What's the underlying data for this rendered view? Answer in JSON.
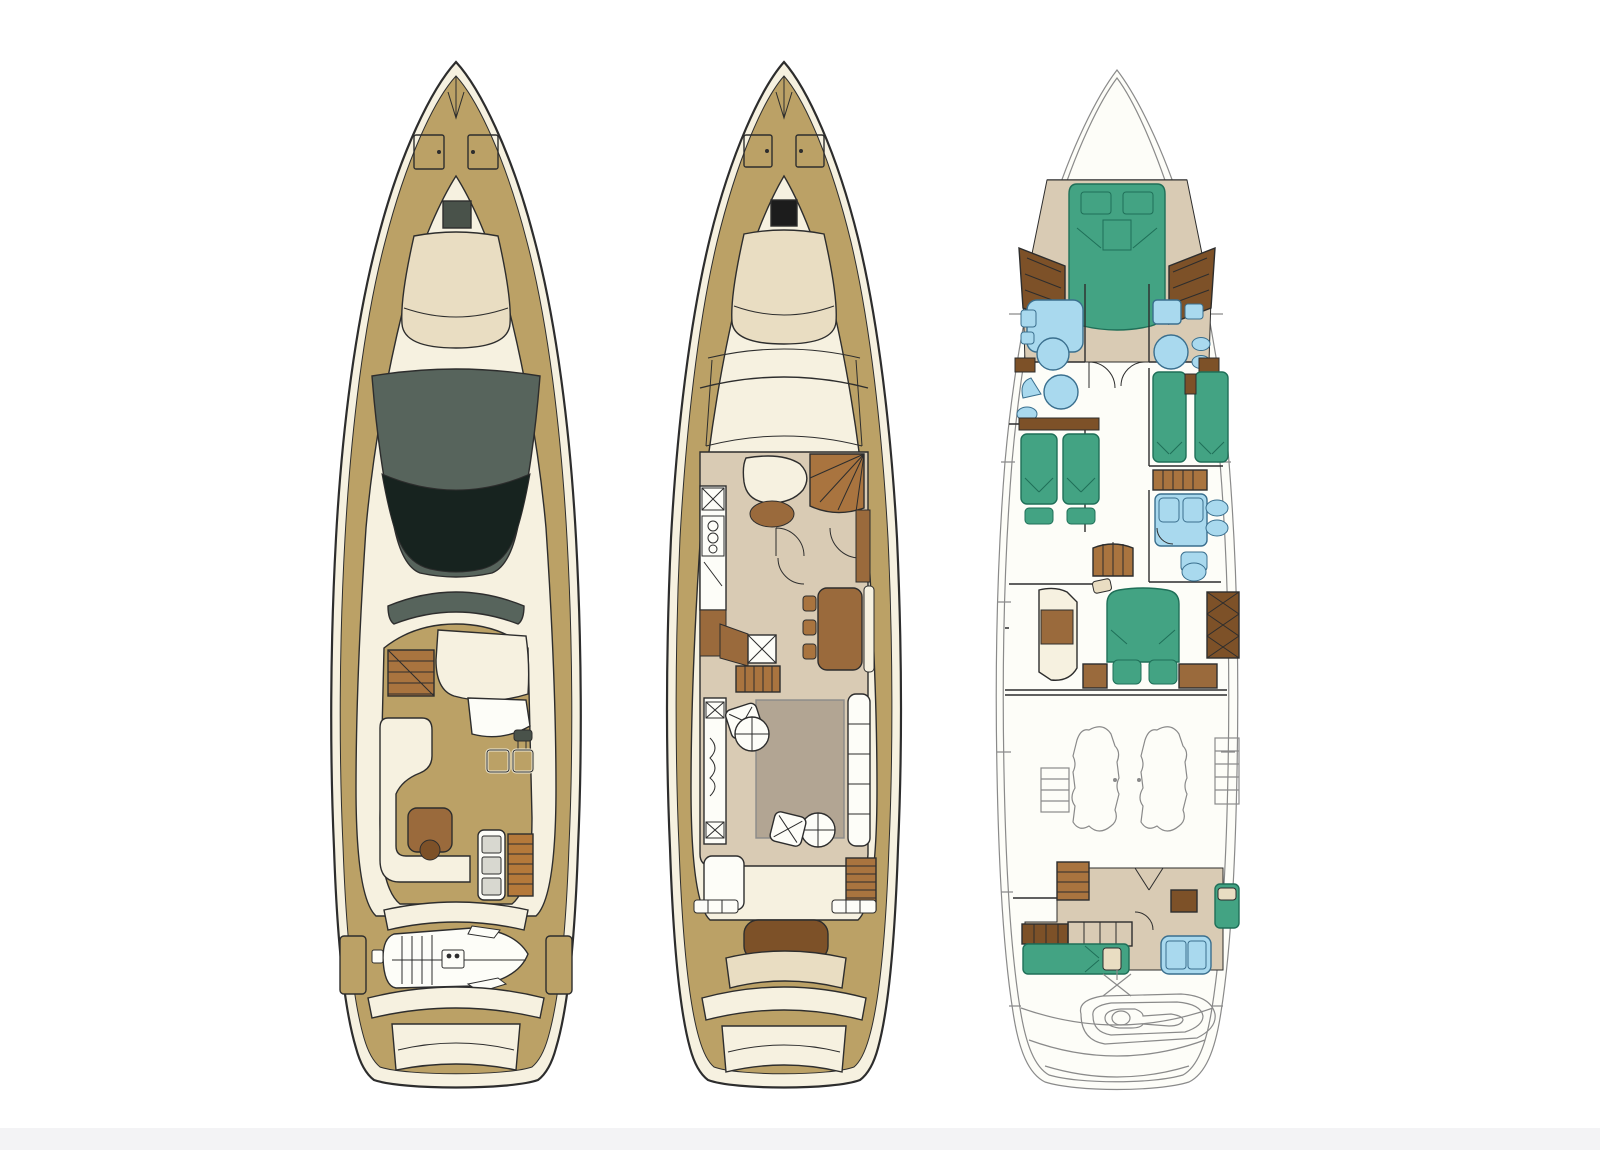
{
  "diagram": {
    "kind": "yacht-deck-plans",
    "views": [
      {
        "id": "flybridge-deck-plan",
        "features": [
          "bow-sunpad",
          "foredeck-hatches",
          "skylight-hatch",
          "dark-sunroof",
          "flybridge-stairs",
          "flybridge-sunbed",
          "helm-console",
          "helm-seats",
          "l-settee",
          "flybridge-table",
          "sun-lounger",
          "tender",
          "swim-platform"
        ]
      },
      {
        "id": "main-deck-plan",
        "features": [
          "bow-sunpad",
          "foredeck-hatches",
          "black-hatch",
          "windshield",
          "helm-seat",
          "interior-stairs",
          "galley",
          "dining-table",
          "salon-rug",
          "salon-sofa",
          "armchairs",
          "coffee-tables",
          "aft-stairs",
          "cockpit-bench",
          "swim-platform"
        ]
      },
      {
        "id": "lower-deck-plan",
        "features": [
          "vip-double-bed",
          "wardrobes",
          "port-bathroom",
          "starboard-bathroom",
          "twin-guest-cabin-port",
          "twin-guest-cabin-starboard",
          "guest-ensuite",
          "corridor-stairs",
          "master-double-bed",
          "master-sofa",
          "master-wardrobe",
          "engine-room",
          "engines",
          "crew-beds",
          "crew-shower",
          "tender-garage",
          "jet-tender"
        ]
      }
    ]
  },
  "palette": {
    "canvas_white": "#ffffff",
    "strip_grey": "#f3f3f5",
    "outline_dark": "#2d2d2d",
    "outline_light": "#8a8a8a",
    "hull_cream": "#f6f1e0",
    "paper_white": "#fdfdf8",
    "deck_tan": "#bba166",
    "pad_beige": "#e9ddc2",
    "floor_taupe": "#d9cbb4",
    "rug_grey": "#b2a593",
    "wood_brown": "#9a6a3c",
    "wood_dark": "#7d5128",
    "stair_brown": "#a9743f",
    "bed_green": "#43a383",
    "bed_green_line": "#1f6f58",
    "fixture_blue": "#a9d9ee",
    "fixture_blue_line": "#3a6f8e",
    "cushion_grey": "#d8d8d0",
    "mat_wood": "#b5793a",
    "glass_green": "#57645c",
    "glass_dark": "#17231f",
    "hatch_dark": "#49524a",
    "hatch_black": "#1c1c1c"
  }
}
